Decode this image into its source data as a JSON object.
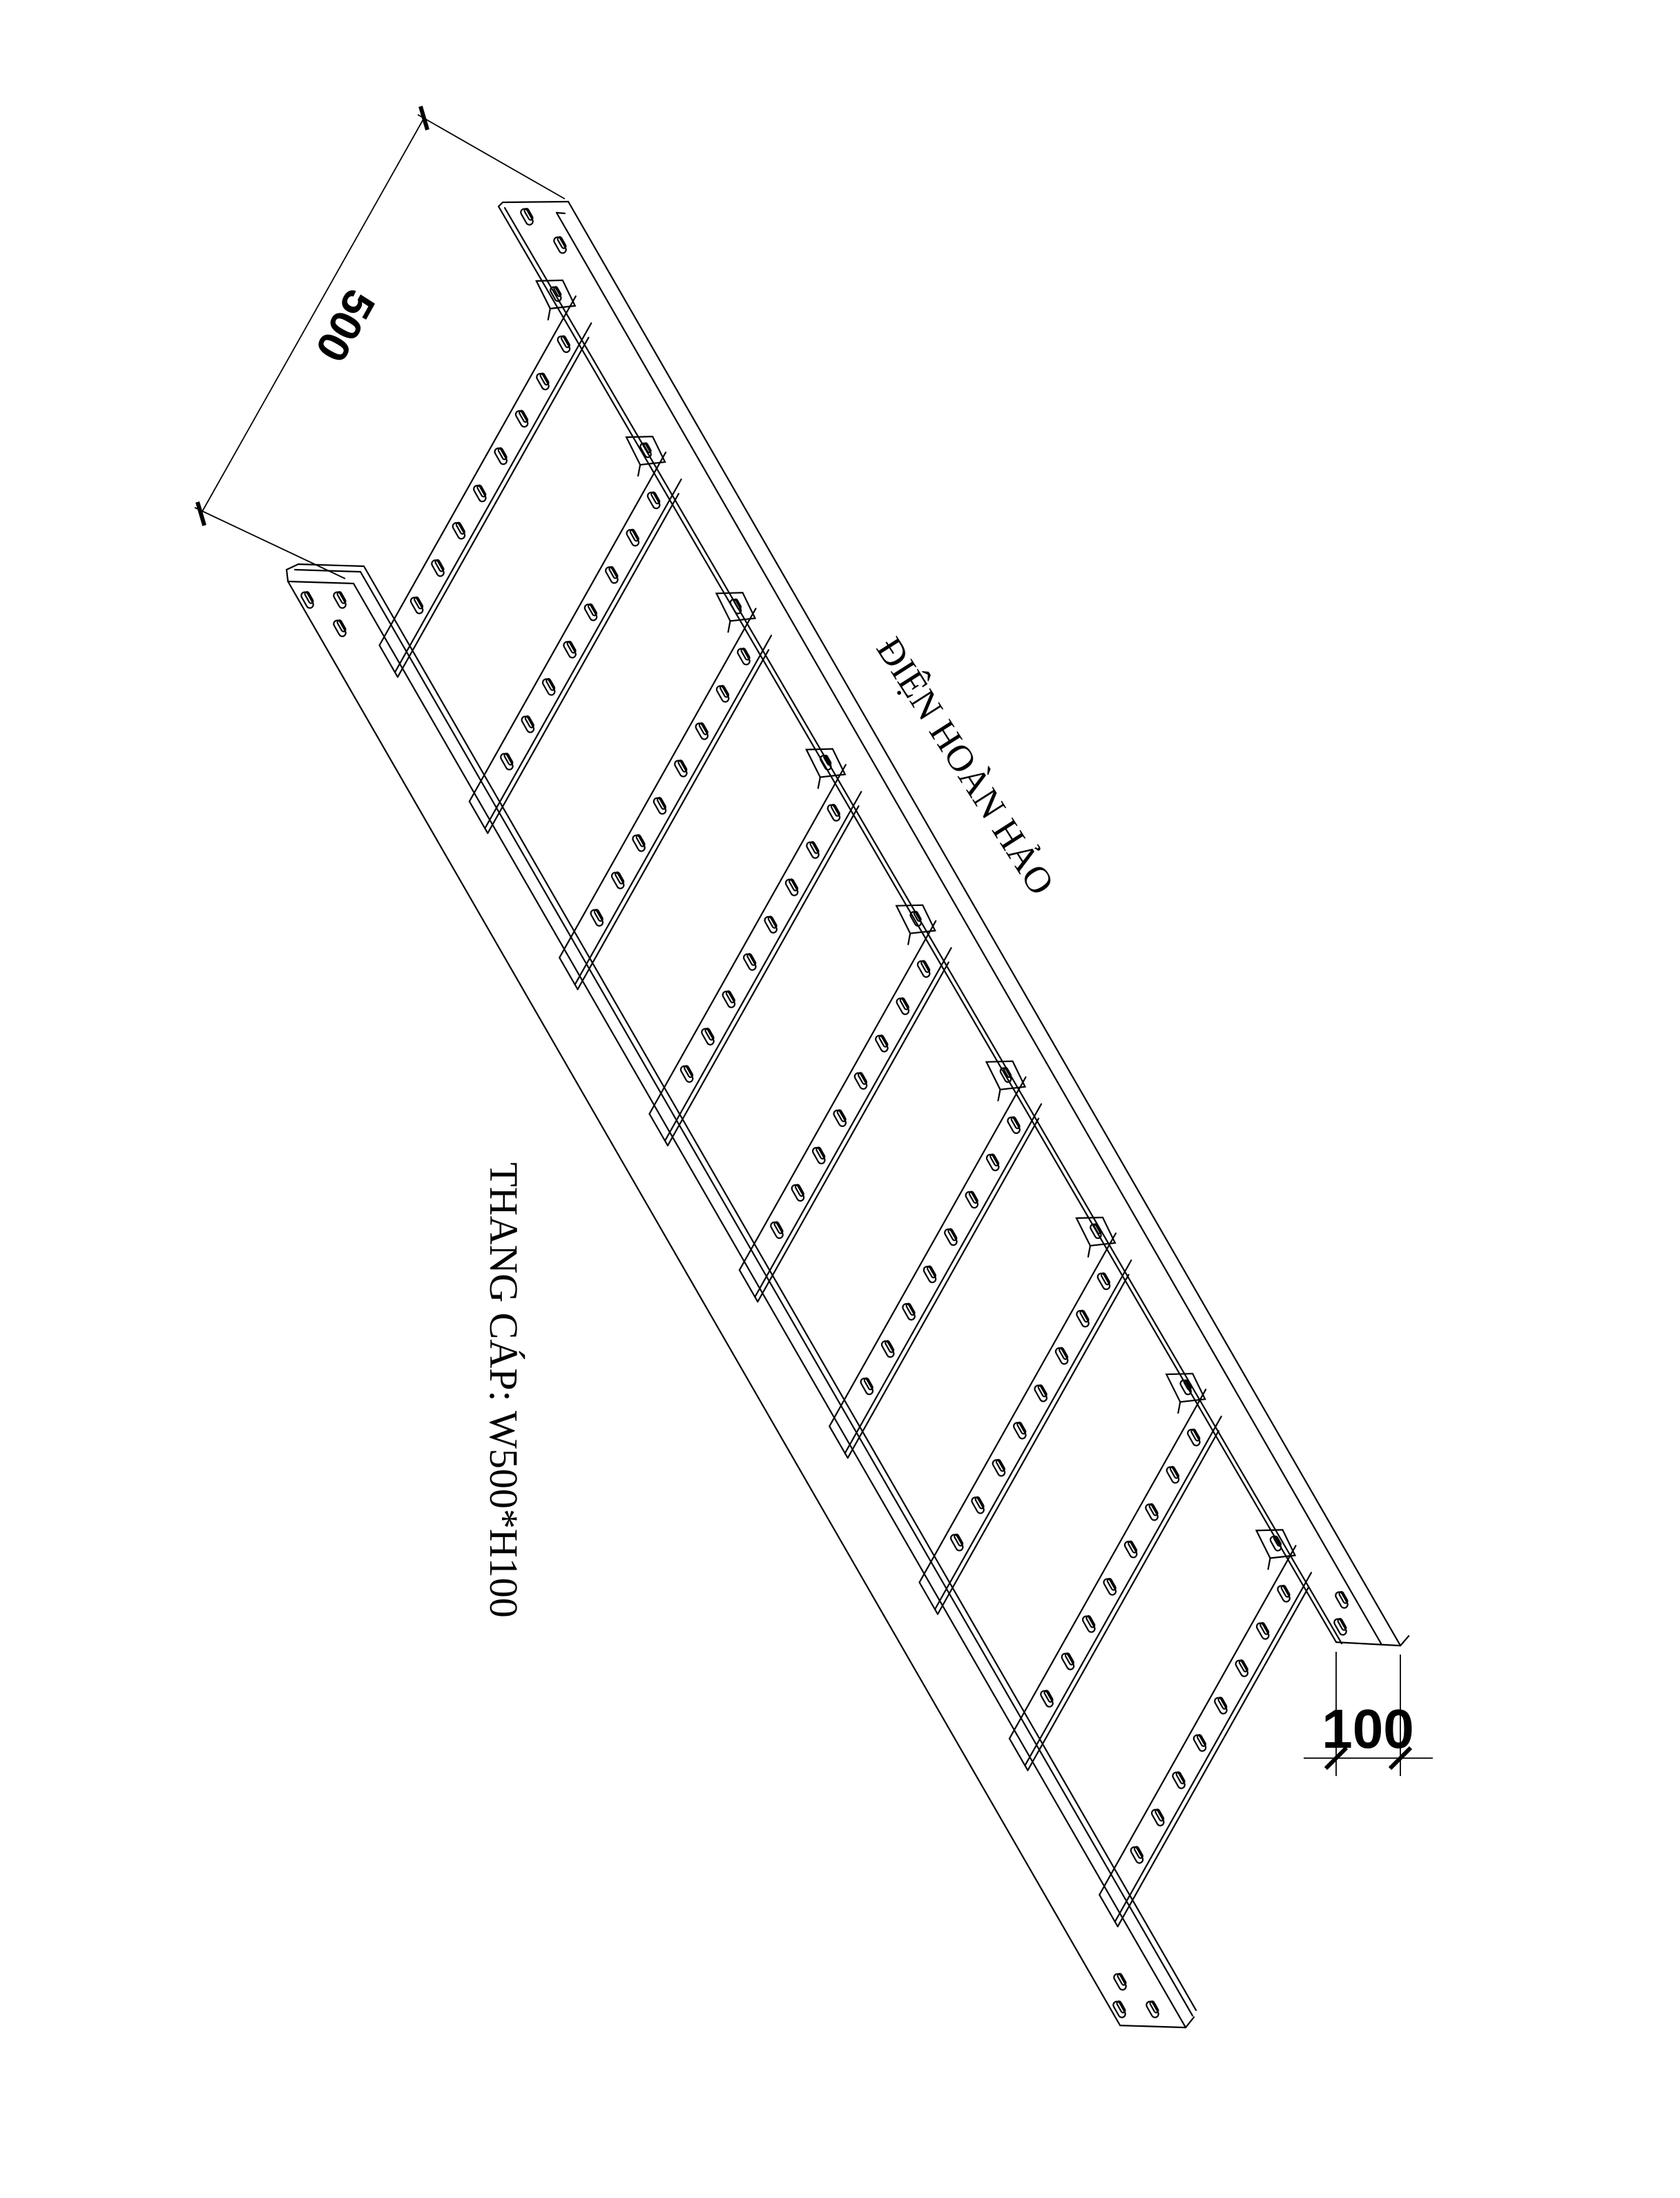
{
  "page": {
    "background_color": "#ffffff",
    "line_color": "#000000"
  },
  "labels": {
    "brand": "ĐIỆN HOÀN HẢO",
    "product": "THANG CÁP: W500*H100"
  },
  "dimensions": {
    "width": {
      "value": "500"
    },
    "height": {
      "value": "100"
    }
  },
  "drawing": {
    "type": "isometric-cad-line-drawing",
    "subject": "perforated cable ladder tray",
    "rung_count": 9,
    "slots_per_rung": 8,
    "rail_end_slots_right_rail": 2,
    "rail_end_slots_left_rail": 3
  }
}
